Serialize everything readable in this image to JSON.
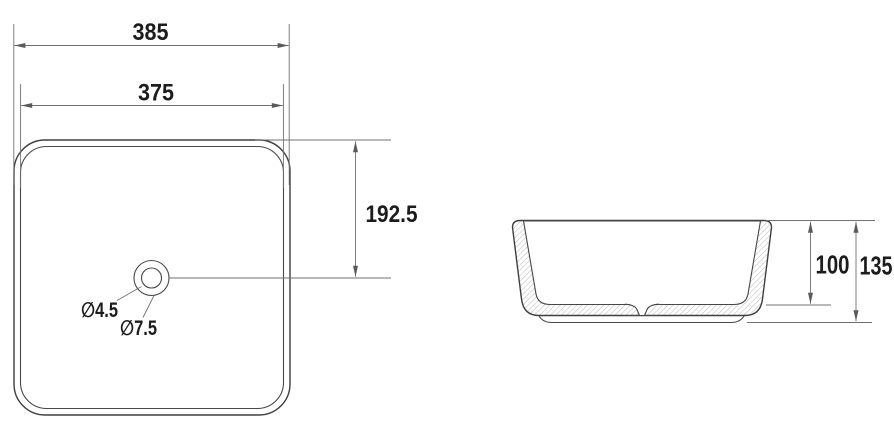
{
  "meta": {
    "drawing_type": "vessel basin technical drawing",
    "ink_color": "#3f3f3f",
    "dim_line_color": "#707070",
    "hatch_color": "#9b9b9b"
  },
  "top_view": {
    "dim_overall_width": "385",
    "dim_inner_width": "375",
    "dim_drain_center_offset": "192.5",
    "dim_hole_small": "∅4.5",
    "dim_hole_large": "∅7.5"
  },
  "side_view": {
    "dim_bowl_depth": "100",
    "dim_overall_height": "135"
  }
}
